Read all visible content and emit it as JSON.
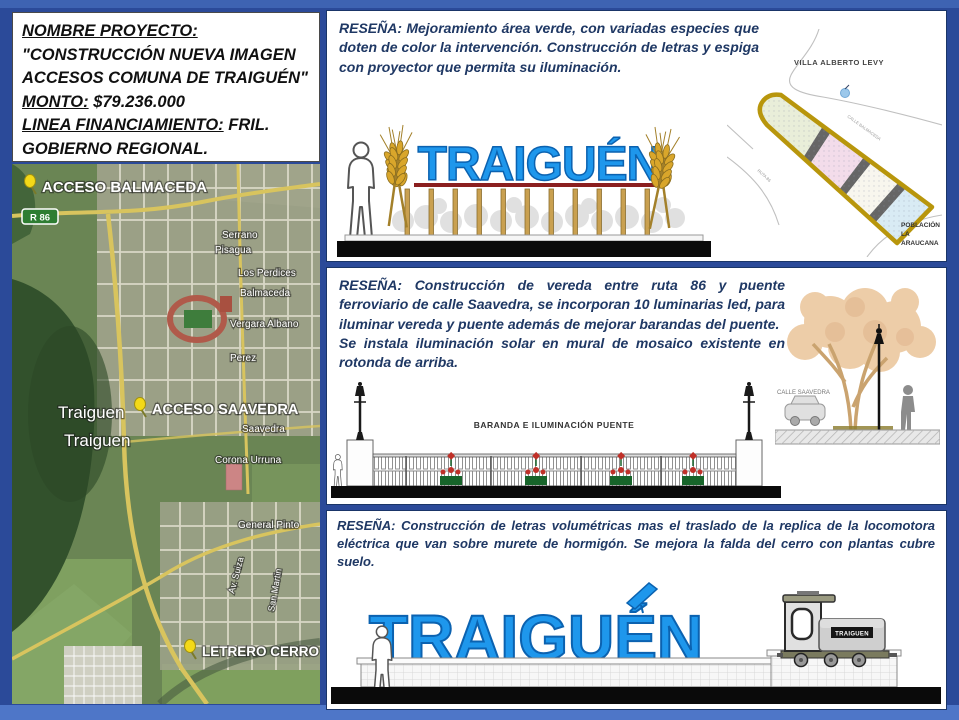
{
  "info": {
    "line1": "NOMBRE PROYECTO:",
    "line2": "\"CONSTRUCCIÓN NUEVA IMAGEN",
    "line3": "ACCESOS COMUNA DE TRAIGUÉN\"",
    "monto_label": "MONTO:",
    "monto_value": " $79.236.000",
    "linea_label": "LINEA FINANCIAMIENTO:",
    "linea_value": " FRIL.",
    "line6": "GOBIERNO REGIONAL."
  },
  "map": {
    "markers": {
      "acceso_balmaceda": "ACCESO BALMACEDA",
      "acceso_saavedra": "ACCESO SAAVEDRA",
      "letrero_cerro": "LETRERO CERRO"
    },
    "route_badge": "R 86",
    "place1": "Traiguen",
    "place2": "Traiguen",
    "streets": {
      "serrano": "Serrano",
      "pisagua": "Pisagua",
      "los_perdices": "Los Perdices",
      "balmaceda": "Balmaceda",
      "vergara_albano": "Vergara Albano",
      "perez": "Perez",
      "saavedra": "Saavedra",
      "corona_urruna": "Corona Urruna",
      "general_pinto": "General Pinto",
      "av_suiza": "Av. Suiza",
      "san_martin": "San Martin"
    }
  },
  "p1": {
    "resena_label": "RESEÑA:",
    "resena_text": "Mejoramiento área verde, con variadas especies que doten de color la intervención. Construcción de letras y espiga con proyector que permita su iluminación.",
    "sign_word": "TRAIGUÉN",
    "plan": {
      "villa": "VILLA ALBERTO LEVY",
      "poblacion_l1": "POBLACIÓN",
      "poblacion_l2": "LA",
      "poblacion_l3": "ARAUCANA",
      "calle": "CALLE BALMACEDA",
      "ruta": "RUTA 86"
    }
  },
  "p2": {
    "resena_label": "RESEÑA:",
    "resena_text": "Construcción de vereda entre ruta 86 y puente ferroviario de calle Saavedra, se incorporan 10 luminarias led, para iluminar vereda y puente además de mejorar barandas del puente.",
    "resena_text2": "Se instala iluminación solar en mural de mosaico existente en rotonda de arriba.",
    "bridge_label": "BARANDA E ILUMINACIÓN PUENTE",
    "calle_saavedra": "CALLE SAAVEDRA"
  },
  "p3": {
    "resena_label": "RESEÑA:",
    "resena_text": "Construcción de letras volumétricas mas el traslado de la replica de la locomotora eléctrica que van sobre murete de hormigón. Se mejora la falda del cerro con plantas cubre suelo.",
    "sign_word": "TRAIGUÉN",
    "loco_label": "TRAIGUEN"
  }
}
